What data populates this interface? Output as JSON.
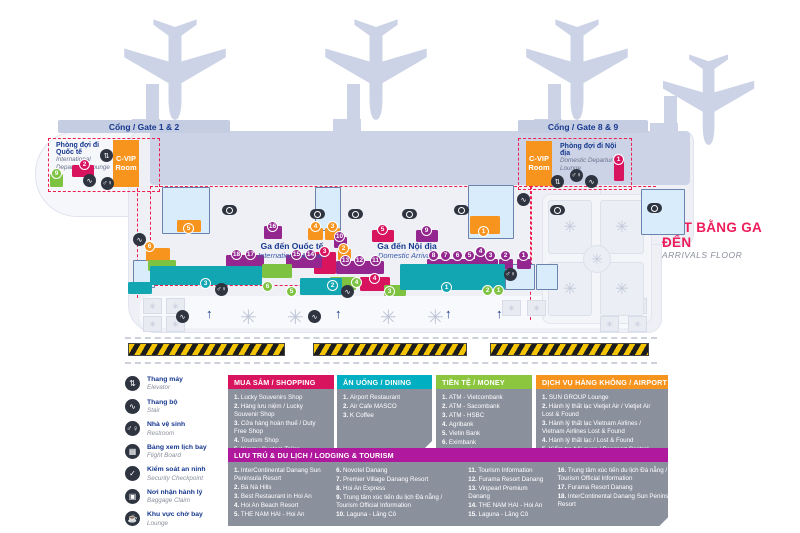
{
  "title": {
    "vi": "MẶT BẰNG GA ĐẾN",
    "en": "ARRIVALS FLOOR"
  },
  "gates": {
    "left": "Cổng / Gate 1 & 2",
    "right": "Cổng / Gate 8 & 9"
  },
  "lounges": {
    "intl": {
      "vi": "Phòng đợi đi Quốc tế",
      "en": "International Departures Lounge"
    },
    "dom": {
      "vi": "Phòng đợi đi Nội địa",
      "en": "Domestic Departures Lounge"
    },
    "cvip": "C-VIP Room"
  },
  "arrivals": {
    "intl": {
      "vi": "Ga đến Quốc tế",
      "en": "International Arrivals"
    },
    "dom": {
      "vi": "Ga đến Nội địa",
      "en": "Domestic Arrivals"
    }
  },
  "legend": {
    "items": [
      {
        "vi": "Thang máy",
        "en": "Elevator",
        "icon": "elevator"
      },
      {
        "vi": "Thang bộ",
        "en": "Stair",
        "icon": "stair"
      },
      {
        "vi": "Nhà vệ sinh",
        "en": "Restroom",
        "icon": "restroom"
      },
      {
        "vi": "Bảng xem lịch bay",
        "en": "Flight Board",
        "icon": "flight-board"
      },
      {
        "vi": "Kiểm soát an ninh",
        "en": "Security Checkpoint",
        "icon": "security"
      },
      {
        "vi": "Nơi nhận hành lý",
        "en": "Baggage Claim",
        "icon": "baggage"
      },
      {
        "vi": "Khu vực chờ bay",
        "en": "Lounge",
        "icon": "lounge"
      }
    ]
  },
  "panels": {
    "shopping": {
      "title": "MUA SẮM / SHOPPING",
      "color": "#d8145f",
      "items": [
        "Lucky Souvenirs Shop",
        "Hàng lưu niệm / Lucky Souvenir Shop",
        "Cửa hàng hoàn thuế / Duty Free Shop",
        "Tourism Shop",
        "Kimmy Custom Tailor"
      ]
    },
    "dining": {
      "title": "ĂN UỐNG / DINING",
      "color": "#00afc1",
      "items": [
        "Airport Restaurant",
        "Air Cafe MASCO",
        "K Coffee"
      ]
    },
    "money": {
      "title": "TIỀN TỆ / MONEY",
      "color": "#8cc63e",
      "items": [
        "ATM - Vietcombank",
        "ATM - Sacombank",
        "ATM - HSBC",
        "Agribank",
        "Vietin Bank",
        "Eximbank",
        "Quầy đổi tiền / Money Exchange"
      ]
    },
    "service": {
      "title": "DỊCH VỤ HÀNG KHÔNG / AIRPORT SERVICE",
      "color": "#f7941e",
      "items": [
        "SUN GROUP Lounge",
        "Hành lý thất lạc Vietjet Air / Vietjet Air Lost & Found",
        "Hành lý thất lạc Vietnam Airlines / Vietnam Airlines Lost & Found",
        "Hành lý thất lạc / Lost & Found",
        "Kiểm tra hải quan / Passport Control",
        "Kiểm dịch y tế / Health Quarantine"
      ]
    },
    "lodging": {
      "title": "LƯU TRÚ & DU LỊCH / LODGING & TOURISM",
      "color": "#b0189e",
      "start_numbers": [
        1,
        6,
        11,
        16
      ],
      "columns": [
        [
          "InterContinental Danang Sun Peninsula Resort",
          "Bà Nà Hills",
          "Best Restaurant in Hoi An",
          "Hoi An Beach Resort",
          "THE NAM HAI - Hoi An"
        ],
        [
          "Novotel Danang",
          "Premier Village Danang Resort",
          "Hoi An Express",
          "Trung tâm xúc tiến du lịch Đà nẵng / Tourism Official Information",
          "Laguna - Lăng Cô"
        ],
        [
          "Tourism Information",
          "Furama Resort Danang",
          "Vinpearl Premium Danang",
          "THE NAM HAI - Hoi An",
          "Laguna - Lăng Cô"
        ],
        [
          "Trung tâm xúc tiến du lịch Đà nẵng / Tourism Official Information",
          "Furama Resort Danang",
          "InterContinental Danang Sun Peninsula Resort"
        ]
      ]
    }
  },
  "colors": {
    "crimson": "#d8145f",
    "purple": "#93278f",
    "teal": "#12a5b2",
    "green": "#7ec242",
    "orange": "#f7941e",
    "navy": "#16388e",
    "dark": "#2e3440",
    "plane": "#ccd3e6"
  },
  "map": {
    "planes": [
      {
        "x": 121,
        "y": 10,
        "s": 1
      },
      {
        "x": 322,
        "y": 10,
        "s": 1
      },
      {
        "x": 523,
        "y": 10,
        "s": 1
      },
      {
        "x": 660,
        "y": 46,
        "s": 0.9
      }
    ],
    "bridges": [
      {
        "x": 146,
        "y": 84,
        "w": 13,
        "h": 50
      },
      {
        "x": 132,
        "y": 119,
        "w": 28,
        "h": 13
      },
      {
        "x": 347,
        "y": 84,
        "w": 13,
        "h": 50
      },
      {
        "x": 333,
        "y": 119,
        "w": 28,
        "h": 13
      },
      {
        "x": 548,
        "y": 84,
        "w": 13,
        "h": 50
      },
      {
        "x": 534,
        "y": 119,
        "w": 28,
        "h": 13
      },
      {
        "x": 664,
        "y": 96,
        "w": 13,
        "h": 40
      },
      {
        "x": 650,
        "y": 123,
        "w": 28,
        "h": 12
      }
    ],
    "rooms": [
      {
        "x": 162,
        "y": 187,
        "w": 46,
        "h": 45
      },
      {
        "x": 315,
        "y": 187,
        "w": 24,
        "h": 42
      },
      {
        "x": 468,
        "y": 185,
        "w": 44,
        "h": 52
      },
      {
        "x": 641,
        "y": 189,
        "w": 42,
        "h": 44
      },
      {
        "x": 133,
        "y": 260,
        "w": 20,
        "h": 26
      },
      {
        "x": 505,
        "y": 264,
        "w": 28,
        "h": 24
      },
      {
        "x": 536,
        "y": 264,
        "w": 20,
        "h": 24
      }
    ],
    "blocks": [
      {
        "c": "orange",
        "x": 146,
        "y": 248,
        "w": 24,
        "h": 13
      },
      {
        "c": "orange",
        "x": 177,
        "y": 220,
        "w": 24,
        "h": 12
      },
      {
        "c": "orange",
        "x": 308,
        "y": 228,
        "w": 15,
        "h": 12
      },
      {
        "c": "orange",
        "x": 325,
        "y": 228,
        "w": 15,
        "h": 12
      },
      {
        "c": "orange",
        "x": 338,
        "y": 249,
        "w": 13,
        "h": 11
      },
      {
        "c": "orange",
        "x": 470,
        "y": 216,
        "w": 30,
        "h": 18
      },
      {
        "c": "crimson",
        "x": 72,
        "y": 165,
        "w": 22,
        "h": 12
      },
      {
        "c": "crimson",
        "x": 614,
        "y": 158,
        "w": 10,
        "h": 23
      },
      {
        "c": "crimson",
        "x": 314,
        "y": 252,
        "w": 22,
        "h": 22
      },
      {
        "c": "crimson",
        "x": 372,
        "y": 230,
        "w": 22,
        "h": 12
      },
      {
        "c": "crimson",
        "x": 360,
        "y": 277,
        "w": 30,
        "h": 14
      },
      {
        "c": "purple",
        "x": 264,
        "y": 226,
        "w": 18,
        "h": 13
      },
      {
        "c": "purple",
        "x": 226,
        "y": 255,
        "w": 38,
        "h": 13
      },
      {
        "c": "purple",
        "x": 286,
        "y": 255,
        "w": 36,
        "h": 13
      },
      {
        "c": "purple",
        "x": 336,
        "y": 261,
        "w": 48,
        "h": 13
      },
      {
        "c": "purple",
        "x": 334,
        "y": 237,
        "w": 13,
        "h": 11
      },
      {
        "c": "purple",
        "x": 416,
        "y": 230,
        "w": 22,
        "h": 12
      },
      {
        "c": "purple",
        "x": 427,
        "y": 259,
        "w": 14,
        "h": 10
      },
      {
        "c": "purple",
        "x": 439,
        "y": 259,
        "w": 14,
        "h": 10
      },
      {
        "c": "purple",
        "x": 451,
        "y": 259,
        "w": 14,
        "h": 10
      },
      {
        "c": "purple",
        "x": 463,
        "y": 259,
        "w": 14,
        "h": 10
      },
      {
        "c": "purple",
        "x": 475,
        "y": 255,
        "w": 12,
        "h": 10
      },
      {
        "c": "purple",
        "x": 484,
        "y": 259,
        "w": 14,
        "h": 10
      },
      {
        "c": "purple",
        "x": 499,
        "y": 259,
        "w": 14,
        "h": 10
      },
      {
        "c": "purple",
        "x": 517,
        "y": 259,
        "w": 14,
        "h": 10
      },
      {
        "c": "green",
        "x": 148,
        "y": 260,
        "w": 28,
        "h": 11
      },
      {
        "c": "green",
        "x": 262,
        "y": 264,
        "w": 30,
        "h": 14
      },
      {
        "c": "green",
        "x": 330,
        "y": 277,
        "w": 26,
        "h": 13
      },
      {
        "c": "green",
        "x": 384,
        "y": 285,
        "w": 22,
        "h": 11
      },
      {
        "c": "green",
        "x": 50,
        "y": 174,
        "w": 13,
        "h": 13
      },
      {
        "c": "teal",
        "x": 150,
        "y": 266,
        "w": 112,
        "h": 19
      },
      {
        "c": "teal",
        "x": 128,
        "y": 282,
        "w": 24,
        "h": 12
      },
      {
        "c": "teal",
        "x": 300,
        "y": 278,
        "w": 42,
        "h": 17
      },
      {
        "c": "teal",
        "x": 400,
        "y": 264,
        "w": 105,
        "h": 26
      }
    ],
    "badges": [
      {
        "c": "crimson",
        "n": "2",
        "x": 85,
        "y": 165
      },
      {
        "c": "crimson",
        "n": "1",
        "x": 619,
        "y": 160
      },
      {
        "c": "crimson",
        "n": "3",
        "x": 325,
        "y": 252
      },
      {
        "c": "crimson",
        "n": "5",
        "x": 383,
        "y": 230
      },
      {
        "c": "crimson",
        "n": "4",
        "x": 375,
        "y": 279
      },
      {
        "c": "purple",
        "n": "18",
        "x": 237,
        "y": 255
      },
      {
        "c": "purple",
        "n": "17",
        "x": 251,
        "y": 255
      },
      {
        "c": "purple",
        "n": "16",
        "x": 273,
        "y": 227
      },
      {
        "c": "purple",
        "n": "15",
        "x": 297,
        "y": 255
      },
      {
        "c": "purple",
        "n": "14",
        "x": 311,
        "y": 255
      },
      {
        "c": "purple",
        "n": "13",
        "x": 346,
        "y": 261
      },
      {
        "c": "purple",
        "n": "12",
        "x": 360,
        "y": 261
      },
      {
        "c": "purple",
        "n": "11",
        "x": 376,
        "y": 261
      },
      {
        "c": "purple",
        "n": "10",
        "x": 340,
        "y": 237
      },
      {
        "c": "purple",
        "n": "9",
        "x": 427,
        "y": 231
      },
      {
        "c": "purple",
        "n": "8",
        "x": 434,
        "y": 256
      },
      {
        "c": "purple",
        "n": "7",
        "x": 446,
        "y": 256
      },
      {
        "c": "purple",
        "n": "6",
        "x": 458,
        "y": 256
      },
      {
        "c": "purple",
        "n": "5",
        "x": 470,
        "y": 256
      },
      {
        "c": "purple",
        "n": "4",
        "x": 481,
        "y": 252
      },
      {
        "c": "purple",
        "n": "3",
        "x": 491,
        "y": 256
      },
      {
        "c": "purple",
        "n": "2",
        "x": 506,
        "y": 256
      },
      {
        "c": "purple",
        "n": "1",
        "x": 524,
        "y": 256
      },
      {
        "c": "orange",
        "n": "6",
        "x": 150,
        "y": 247
      },
      {
        "c": "orange",
        "n": "5",
        "x": 189,
        "y": 229
      },
      {
        "c": "orange",
        "n": "4",
        "x": 316,
        "y": 227
      },
      {
        "c": "orange",
        "n": "3",
        "x": 333,
        "y": 227
      },
      {
        "c": "orange",
        "n": "2",
        "x": 344,
        "y": 249
      },
      {
        "c": "orange",
        "n": "1",
        "x": 484,
        "y": 232
      },
      {
        "c": "teal",
        "n": "3",
        "x": 206,
        "y": 284
      },
      {
        "c": "teal",
        "n": "2",
        "x": 333,
        "y": 286
      },
      {
        "c": "teal",
        "n": "1",
        "x": 447,
        "y": 288
      },
      {
        "c": "green",
        "n": "9",
        "x": 57,
        "y": 174
      },
      {
        "c": "green",
        "n": "6",
        "x": 268,
        "y": 287
      },
      {
        "c": "green",
        "n": "5",
        "x": 292,
        "y": 292
      },
      {
        "c": "green",
        "n": "4",
        "x": 357,
        "y": 283
      },
      {
        "c": "green",
        "n": "3",
        "x": 390,
        "y": 292
      },
      {
        "c": "green",
        "n": "2",
        "x": 488,
        "y": 291
      },
      {
        "c": "green",
        "n": "1",
        "x": 499,
        "y": 291
      }
    ],
    "icons": [
      {
        "t": "flight-board",
        "x": 230,
        "y": 210
      },
      {
        "t": "flight-board",
        "x": 318,
        "y": 214
      },
      {
        "t": "flight-board",
        "x": 356,
        "y": 214
      },
      {
        "t": "flight-board",
        "x": 410,
        "y": 214
      },
      {
        "t": "flight-board",
        "x": 462,
        "y": 210
      },
      {
        "t": "flight-board",
        "x": 558,
        "y": 210
      },
      {
        "t": "flight-board",
        "x": 655,
        "y": 208
      },
      {
        "t": "elevator",
        "x": 107,
        "y": 156
      },
      {
        "t": "elevator",
        "x": 558,
        "y": 182
      },
      {
        "t": "restroom",
        "x": 108,
        "y": 184
      },
      {
        "t": "restroom",
        "x": 577,
        "y": 176
      },
      {
        "t": "restroom",
        "x": 222,
        "y": 290
      },
      {
        "t": "restroom",
        "x": 511,
        "y": 275
      },
      {
        "t": "stair",
        "x": 90,
        "y": 181
      },
      {
        "t": "stair",
        "x": 592,
        "y": 182
      },
      {
        "t": "stair",
        "x": 140,
        "y": 240
      },
      {
        "t": "stair",
        "x": 348,
        "y": 292
      },
      {
        "t": "stair",
        "x": 524,
        "y": 200
      },
      {
        "t": "stair",
        "x": 183,
        "y": 317
      },
      {
        "t": "stair",
        "x": 315,
        "y": 317
      }
    ],
    "planters_square": [
      {
        "x": 143,
        "y": 298
      },
      {
        "x": 166,
        "y": 298
      },
      {
        "x": 143,
        "y": 316
      },
      {
        "x": 166,
        "y": 316
      },
      {
        "x": 502,
        "y": 300
      },
      {
        "x": 527,
        "y": 300
      },
      {
        "x": 600,
        "y": 298
      },
      {
        "x": 628,
        "y": 298
      },
      {
        "x": 600,
        "y": 316
      },
      {
        "x": 628,
        "y": 316
      }
    ],
    "planters_round": [
      {
        "x": 240,
        "y": 308
      },
      {
        "x": 287,
        "y": 308
      },
      {
        "x": 380,
        "y": 308
      },
      {
        "x": 427,
        "y": 308
      }
    ],
    "arrows": [
      {
        "x": 206,
        "y": 306
      },
      {
        "x": 335,
        "y": 306
      },
      {
        "x": 445,
        "y": 306
      },
      {
        "x": 496,
        "y": 306
      }
    ],
    "garden_flowers": [
      {
        "x": 548,
        "y": 200
      },
      {
        "x": 600,
        "y": 200
      },
      {
        "x": 548,
        "y": 262
      },
      {
        "x": 600,
        "y": 262
      }
    ]
  }
}
